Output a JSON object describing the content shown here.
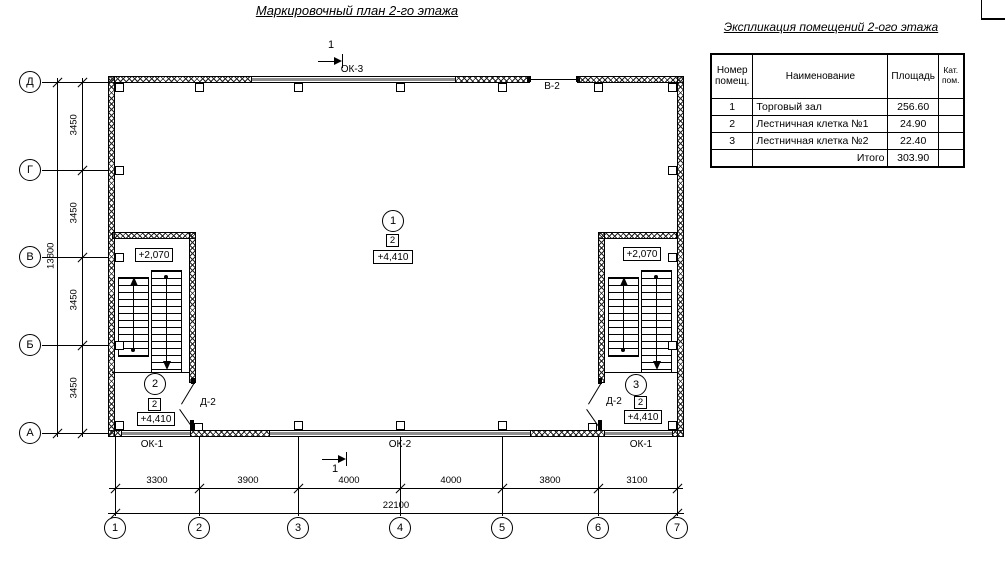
{
  "page": {
    "plan_title": "Маркировочный план 2-го этажа",
    "table_title": "Экспликация помещений 2-ого этажа"
  },
  "table": {
    "col_headers": [
      "Номер\nпомещ.",
      "Наименование",
      "Площадь",
      "Кат.\nпом."
    ],
    "rows": [
      [
        "1",
        "Торговый зал",
        "256.60",
        ""
      ],
      [
        "2",
        "Лестничная клетка №1",
        "24.90",
        ""
      ],
      [
        "3",
        "Лестничная клетка №2",
        "22.40",
        ""
      ]
    ],
    "total": {
      "label": "Итого",
      "value": "303.90"
    }
  },
  "axes": {
    "letters": [
      "Д",
      "Г",
      "В",
      "Б",
      "А"
    ],
    "numbers": [
      "1",
      "2",
      "3",
      "4",
      "5",
      "6",
      "7"
    ]
  },
  "dims": {
    "v_segments": [
      "3450",
      "3450",
      "3450",
      "3450"
    ],
    "v_total": "13800",
    "h_segments": [
      "3300",
      "3900",
      "4000",
      "4000",
      "3800",
      "3100"
    ],
    "h_total": "22100"
  },
  "openings": {
    "ok3": "ОК-3",
    "v2": "В-2",
    "ok1_left": "ОК-1",
    "ok2": "ОК-2",
    "ok1_right": "ОК-1",
    "d2_left": "Д-2",
    "d2_right": "Д-2"
  },
  "sections": {
    "top": "1",
    "bottom": "1"
  },
  "markers": {
    "hall": {
      "circle": "1",
      "square": "2",
      "elev": "+4,410"
    },
    "stair_left": {
      "elev_mid": "+2,070",
      "circle": "2",
      "square": "2",
      "elev": "+4,410"
    },
    "stair_right": {
      "elev_mid": "+2,070",
      "circle": "3",
      "square": "2",
      "elev": "+4,410"
    }
  },
  "colors": {
    "ink": "#000000",
    "window_fill": "#8f8f8f"
  }
}
